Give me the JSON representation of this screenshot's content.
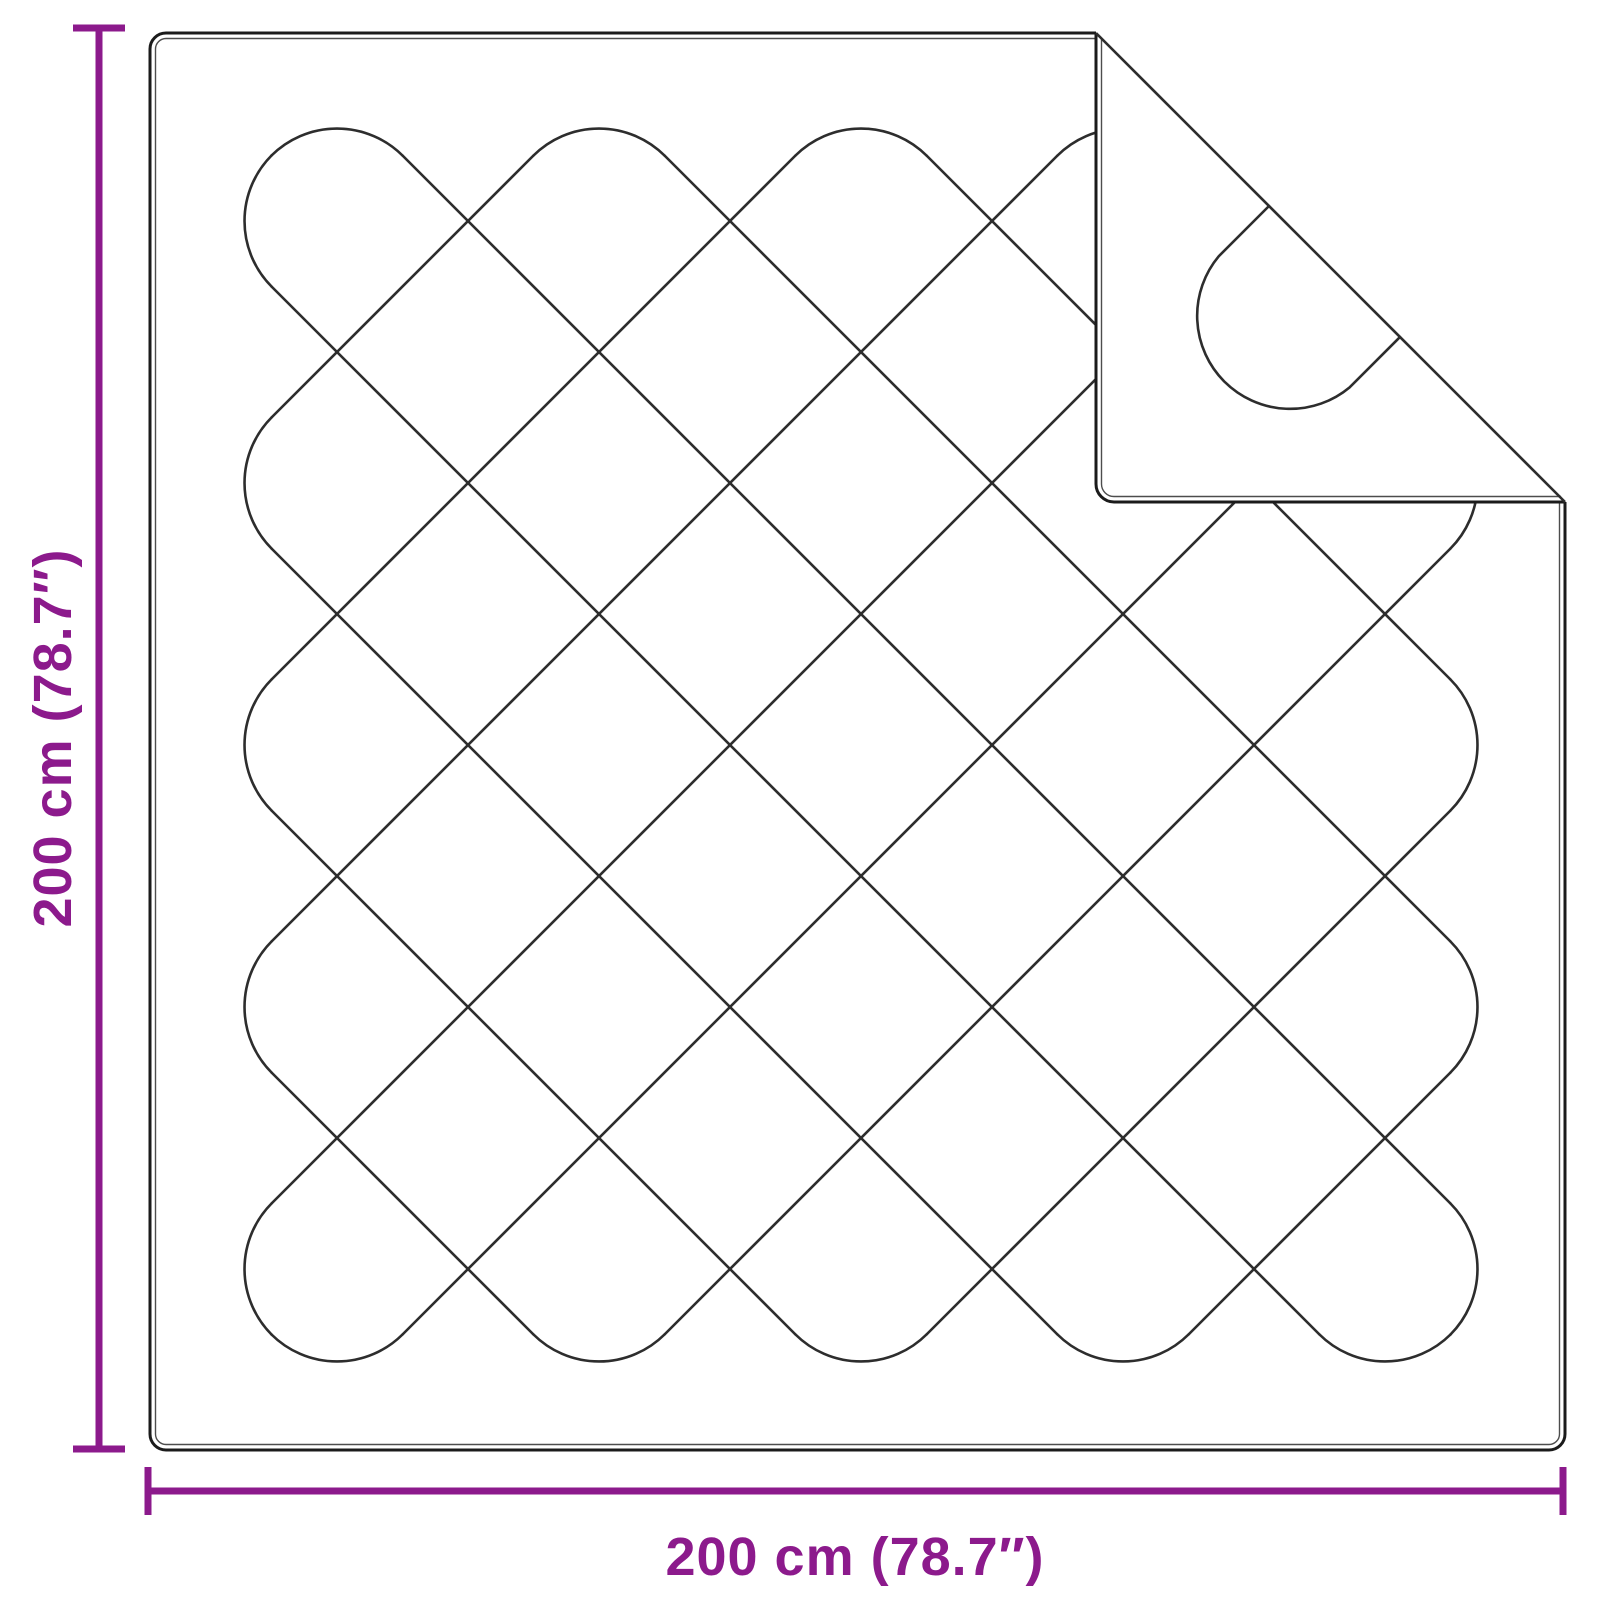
{
  "diagram": {
    "type": "product-dimension-diagram",
    "subject": "quilted-blanket-with-folded-corner",
    "background": "#ffffff",
    "labels": {
      "height": "200 cm (78.7″)",
      "width": "200 cm (78.7″)"
    },
    "colors": {
      "dimension": "#8C1A8C",
      "outline": "#1b1b1b",
      "stitch": "#2d2d2d",
      "inner_edge": "#4d4d4d",
      "fabric": "#ffffff"
    },
    "blanket": {
      "x1": 150,
      "y1": 33,
      "x2": 1565,
      "y2": 1450,
      "corner_radius": 16,
      "edge_inset": 5.5,
      "fold": {
        "ax": 1096,
        "bx": 1565,
        "by": 502,
        "corner_radius": 18
      }
    },
    "pattern": {
      "arc_radius": 93,
      "stroke_width": 2.6,
      "bounds": {
        "left": 206,
        "top": 90,
        "right": 1516,
        "bottom": 1400
      },
      "diag_down_c": [
        -1295,
        -1033,
        -771,
        -509,
        -247,
        15,
        277,
        539,
        801,
        1063
      ],
      "diag_up_d": [
        427,
        689,
        951,
        1213,
        1475,
        1737,
        1999,
        2261,
        2523,
        2785
      ],
      "turns_top": [
        337,
        599,
        861,
        1123,
        1385
      ],
      "turns_bottom": [
        337,
        599,
        861,
        1123,
        1385
      ],
      "turns_left": [
        221,
        483,
        745,
        1007,
        1269
      ],
      "turns_right": [
        221,
        483,
        745,
        1007,
        1269
      ],
      "flap_motif": {
        "r": 93,
        "p1": [
          1269,
          206
        ],
        "p2": [
          1218.8,
          256.2
        ],
        "p3": [
          1349.8,
          387.2
        ],
        "p4": [
          1400,
          337
        ]
      }
    },
    "dimension_lines": {
      "stroke": 7,
      "left": {
        "x": 99,
        "y1": 28,
        "y2": 1449,
        "cap_len": 52
      },
      "bottom": {
        "y": 1491,
        "x1": 148,
        "x2": 1563,
        "cap_len": 48
      }
    }
  }
}
